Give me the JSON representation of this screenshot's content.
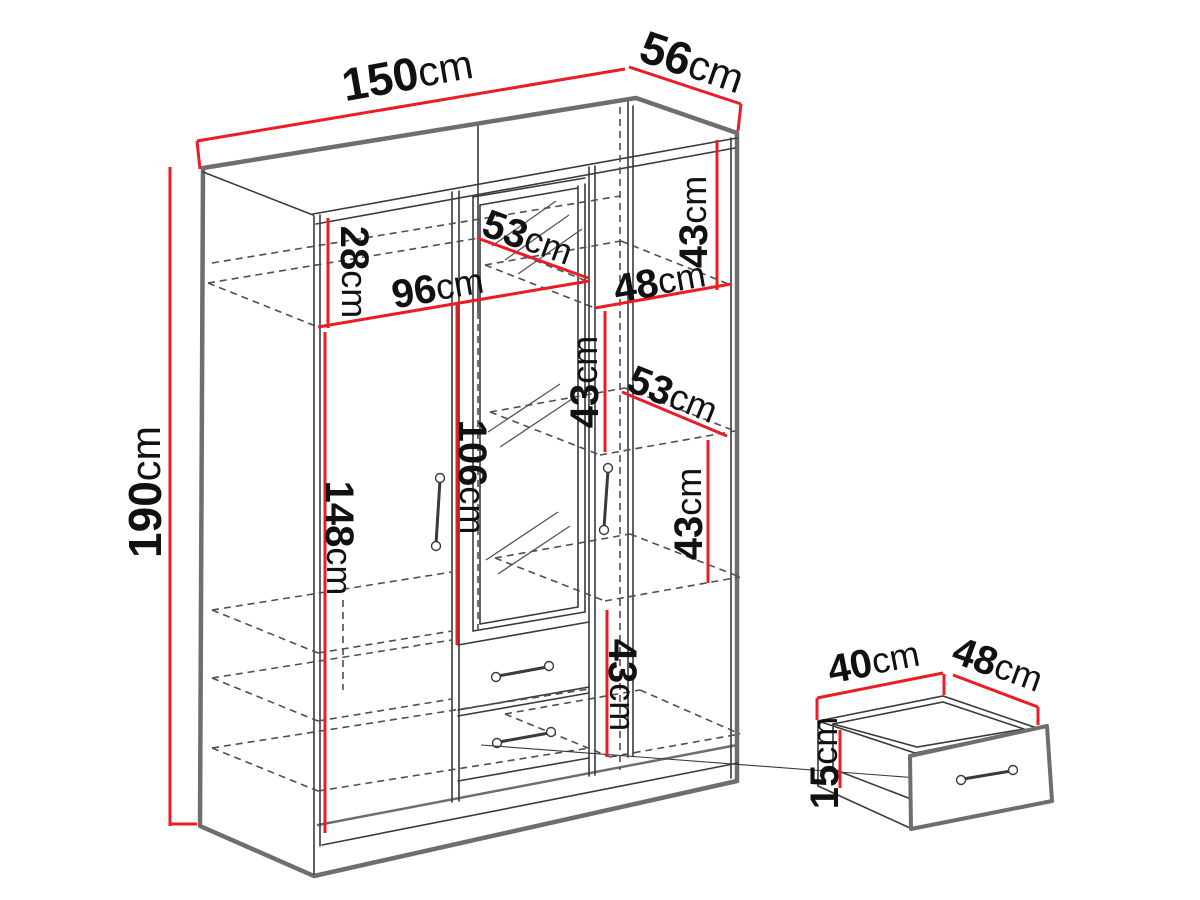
{
  "page": {
    "background": "#ffffff"
  },
  "colors": {
    "dimension_red": "#ec1c24",
    "edge_gray": "#6e6e6e",
    "line_dark": "#3a3a3a",
    "dash_gray": "#4f4f4f",
    "label_text": "#111111"
  },
  "diagram": {
    "type": "furniture-dimension-diagram",
    "subject": "Three-door mirrored wardrobe with internal shelves and two drawers, plus a separate pull-out drawer detail",
    "wardrobe": {
      "width": "150cm",
      "depth": "56cm",
      "height": "190cm",
      "interior": {
        "top_shelf_height": "28cm",
        "left_section_width": "96cm",
        "interior_depth_top": "53cm",
        "right_section_width": "48cm",
        "right_section_shelf_spacing": [
          "43cm",
          "43cm",
          "43cm",
          "43cm"
        ],
        "interior_depth_middle": "53cm",
        "mirror_height": "106cm",
        "hanging_space_height": "148cm"
      }
    },
    "drawer_detail": {
      "width": "40cm",
      "depth": "48cm",
      "height": "15cm"
    }
  },
  "dimension_labels": [
    {
      "num": "150",
      "unit": "cm",
      "x": 408,
      "y": 78,
      "rot": -10,
      "size": 46
    },
    {
      "num": "56",
      "unit": "cm",
      "x": 691,
      "y": 66,
      "rot": 19,
      "size": 46
    },
    {
      "num": "190",
      "unit": "cm",
      "x": 149,
      "y": 492,
      "rot": -90,
      "size": 46
    },
    {
      "num": "28",
      "unit": "cm",
      "x": 352,
      "y": 272,
      "rot": 90,
      "size": 40
    },
    {
      "num": "96",
      "unit": "cm",
      "x": 438,
      "y": 290,
      "rot": -9.5,
      "size": 40
    },
    {
      "num": "53",
      "unit": "cm",
      "x": 527,
      "y": 240,
      "rot": 20,
      "size": 40
    },
    {
      "num": "48",
      "unit": "cm",
      "x": 660,
      "y": 284,
      "rot": -10,
      "size": 40
    },
    {
      "num": "43",
      "unit": "cm",
      "x": 696,
      "y": 222,
      "rot": -90,
      "size": 40
    },
    {
      "num": "43",
      "unit": "cm",
      "x": 587,
      "y": 382,
      "rot": -90,
      "size": 40
    },
    {
      "num": "53",
      "unit": "cm",
      "x": 672,
      "y": 397,
      "rot": 22,
      "size": 40
    },
    {
      "num": "43",
      "unit": "cm",
      "x": 691,
      "y": 514,
      "rot": -90,
      "size": 40
    },
    {
      "num": "106",
      "unit": "cm",
      "x": 470,
      "y": 477,
      "rot": 90,
      "size": 40
    },
    {
      "num": "148",
      "unit": "cm",
      "x": 337,
      "y": 538,
      "rot": 90,
      "size": 40
    },
    {
      "num": "43",
      "unit": "cm",
      "x": 620,
      "y": 685,
      "rot": 90,
      "size": 40
    },
    {
      "num": "40",
      "unit": "cm",
      "x": 874,
      "y": 664,
      "rot": -11,
      "size": 40
    },
    {
      "num": "48",
      "unit": "cm",
      "x": 997,
      "y": 667,
      "rot": 20,
      "size": 40
    },
    {
      "num": "15",
      "unit": "cm",
      "x": 827,
      "y": 763,
      "rot": -90,
      "size": 40
    }
  ],
  "dimension_lines": [
    [
      197,
      141,
      625,
      69
    ],
    [
      629,
      67,
      741,
      104
    ],
    [
      170,
      167,
      170,
      826
    ],
    [
      328,
      218,
      328,
      328
    ],
    [
      318,
      327,
      589,
      281
    ],
    [
      477,
      238,
      588,
      278
    ],
    [
      595,
      308,
      731,
      284
    ],
    [
      717,
      140,
      717,
      290
    ],
    [
      605,
      311,
      605,
      452
    ],
    [
      622,
      392,
      727,
      436
    ],
    [
      708,
      440,
      708,
      583
    ],
    [
      457,
      305,
      457,
      645
    ],
    [
      325,
      332,
      325,
      833
    ],
    [
      607,
      610,
      607,
      757
    ],
    [
      817,
      698,
      943,
      673
    ],
    [
      953,
      675,
      1038,
      707
    ],
    [
      840,
      730,
      840,
      788
    ],
    [
      197,
      141,
      200,
      169
    ],
    [
      741,
      104,
      738,
      131
    ],
    [
      170,
      824,
      197,
      824
    ],
    [
      817,
      698,
      817,
      720
    ],
    [
      944,
      674,
      944,
      695
    ],
    [
      1038,
      707,
      1038,
      725
    ]
  ]
}
